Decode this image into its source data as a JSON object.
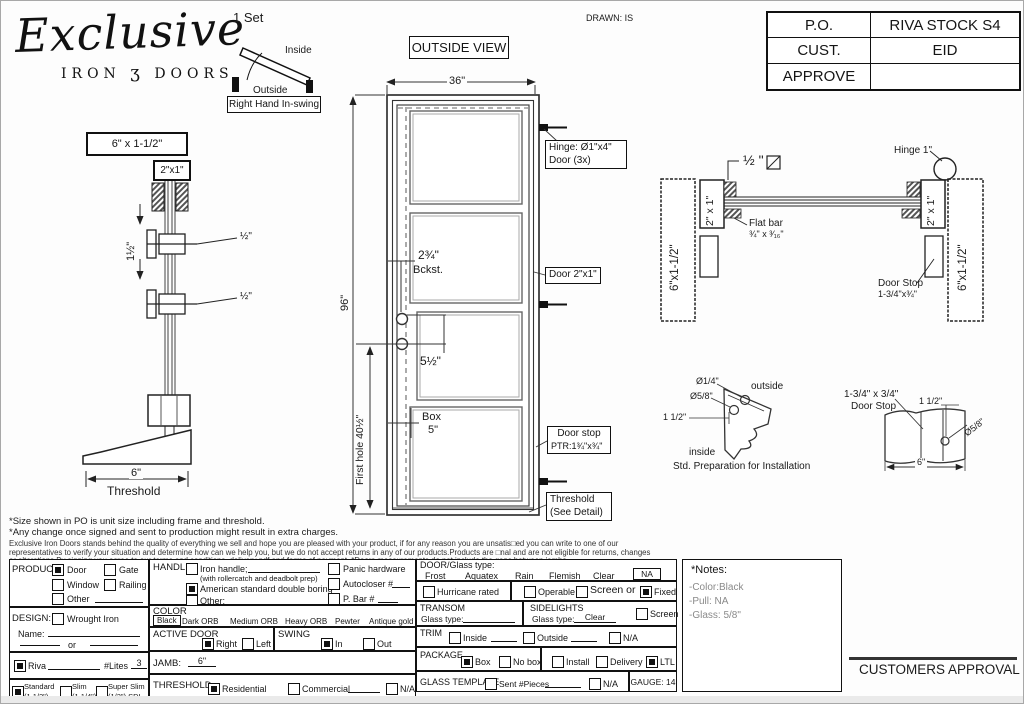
{
  "page": {
    "set_label": "1 Set",
    "drawn_by": "DRAWN: IS",
    "outside_view": "OUTSIDE VIEW",
    "approval_label": "CUSTOMERS APPROVAL"
  },
  "logo": {
    "title": "Exclusive",
    "sub_left": "IRON",
    "ornament": "ʒ",
    "sub_right": "DOORS"
  },
  "swing": {
    "inside": "Inside",
    "outside": "Outside",
    "caption": "Right Hand In-swing"
  },
  "po_table": {
    "rows": [
      {
        "label": "P.O.",
        "value": "RIVA STOCK S4"
      },
      {
        "label": "CUST.",
        "value": "EID"
      },
      {
        "label": "APPROVE",
        "value": ""
      }
    ]
  },
  "jamb_elevation": {
    "head": "6\" x 1-1/2\"",
    "frame": "2\"x1\"",
    "spacing": "1½\"",
    "callout_top": "½\"",
    "callout_bottom": "½\"",
    "base_dim": "6\"",
    "base_label": "Threshold"
  },
  "door_view": {
    "width_dim": "36\"",
    "height_dim": "96\"",
    "first_hole": "First hole 40½\"",
    "backset": "2¾\"",
    "backset_label": "Bckst.",
    "holes_dim": "5½\"",
    "box_label": "Box",
    "box_dim": "5\"",
    "hinge_note_1": "Hinge: Ø1\"x4\"",
    "hinge_note_2": "Door (3x)",
    "door_note": "Door 2\"x1\"",
    "stop_note_1": "Door stop",
    "stop_note_2": "PTR:1¾\"x¾\"",
    "threshold_note_1": "Threshold",
    "threshold_note_2": "(See Detail)"
  },
  "plan_view": {
    "left_jamb": "6\"x1-1/2\"",
    "left_frame": "2\" x 1\"",
    "gap_dim": "½ \"",
    "flat_bar_1": "Flat bar",
    "flat_bar_2": "¾\" x ³⁄₁₆\"",
    "hinge_label": "Hinge 1\"",
    "right_frame": "2\" x 1\"",
    "right_jamb": "6\"x1-1/2\"",
    "stop_1": "Door Stop",
    "stop_2": "1-3/4\"x¾\""
  },
  "corner_detail": {
    "dia_small": "Ø1/4\"",
    "dia_big": "Ø5/8\"",
    "outside": "outside",
    "dim": "1 1/2\"",
    "inside": "inside",
    "caption": "Std. Preparation for Installation"
  },
  "stop_detail": {
    "title_1": "1-3/4\" x 3/4\"",
    "title_2": "Door Stop",
    "dim": "1 1/2\"",
    "dia": "Ø5/8\"",
    "width_dim": "6\""
  },
  "disclaimer": {
    "line1": "*Size shown in PO is unit size including frame and threshold.",
    "line2": "*Any change once signed and sent to production might result in extra charges.",
    "line3": "Exclusive Iron Doors stands behind the quality of everything we sell and hope you are pleased with your product, if for any reason you are unsatis□ed you can write to one of our",
    "line4": "representatives to verify your situation and determine how can we help you, but we do not accept returns in any of our products.Products are □nal and are not eligible for returns, changes",
    "line5": "or alterations.By signing you agree to our terms and conditions, delivery pdf and forms of payment. *Doors measurements do not include the gaps between jambs"
  },
  "form": {
    "product": {
      "label": "PRODUCT:",
      "options": [
        {
          "l": "Door",
          "c": true
        },
        {
          "l": "Gate",
          "c": false
        },
        {
          "l": "Window",
          "c": false
        },
        {
          "l": "Railing",
          "c": false
        },
        {
          "l": "Other",
          "c": false
        }
      ]
    },
    "design": {
      "label": "DESIGN:",
      "wrought": {
        "l": "Wrought Iron",
        "c": false
      },
      "name_label": "Name:",
      "or_label": "or",
      "riva": {
        "l": "Riva",
        "c": true
      },
      "lites_label": "#Lites",
      "lites_value": "3",
      "profiles": [
        {
          "l": "Standard",
          "s": "(1 1/2\")",
          "c": true
        },
        {
          "l": "Slim",
          "s": "(1 1/4\")",
          "c": false
        },
        {
          "l": "Super Slim",
          "s": "(1/2\") SDL",
          "c": false
        }
      ]
    },
    "handle": {
      "label": "HANDLE",
      "options": [
        {
          "l": "Iron handle;",
          "c": false
        },
        {
          "l": "American standard double boring",
          "c": true
        },
        {
          "l": "Other:",
          "c": false
        }
      ],
      "note": "(with rollercatch and deadbolt prep)",
      "extras": [
        {
          "l": "Panic hardware",
          "c": false
        },
        {
          "l": "Autocloser #",
          "c": false
        },
        {
          "l": "P. Bar #",
          "c": false
        }
      ]
    },
    "color": {
      "label": "COLOR",
      "selected": "Black",
      "options": [
        "Black",
        "Dark ORB",
        "Medium ORB",
        "Heavy ORB",
        "Pewter",
        "Antique gold"
      ]
    },
    "active_door": {
      "label": "ACTIVE DOOR",
      "options": [
        {
          "l": "Right",
          "c": true
        },
        {
          "l": "Left",
          "c": false
        }
      ]
    },
    "swing": {
      "label": "SWING",
      "options": [
        {
          "l": "In",
          "c": true
        },
        {
          "l": "Out",
          "c": false
        }
      ]
    },
    "jamb": {
      "label": "JAMB:",
      "value": "6\""
    },
    "threshold": {
      "label": "THRESHOLD",
      "options": [
        {
          "l": "Residential",
          "c": true
        },
        {
          "l": "Commercial",
          "c": false
        },
        {
          "l": "N/A",
          "c": false
        }
      ]
    },
    "door_glass": {
      "label": "DOOR/Glass type:",
      "types": [
        "Frost",
        "Aquatex",
        "Rain",
        "Flemish",
        "Clear"
      ],
      "na": "NA",
      "hurricane": {
        "l": "Hurricane rated",
        "c": false
      },
      "operable": {
        "l": "Operable",
        "c": false
      },
      "screen": {
        "l": "",
        "c": false
      },
      "screen_or": "Screen or",
      "fixed": {
        "l": "Fixed",
        "c": true
      }
    },
    "transom": {
      "label": "TRANSOM",
      "glass_label": "Glass type:"
    },
    "sidelights": {
      "label": "SIDELIGHTS",
      "glass_label": "Glass type:",
      "glass_value": "Clear",
      "screen": {
        "l": "Screen",
        "c": false
      }
    },
    "trim": {
      "label": "TRIM",
      "options": [
        {
          "l": "Inside",
          "c": false
        },
        {
          "l": "Outside",
          "c": false
        },
        {
          "l": "N/A",
          "c": false
        }
      ]
    },
    "package": {
      "label": "PACKAGE",
      "options": [
        {
          "l": "Box",
          "c": true
        },
        {
          "l": "No box",
          "c": false
        },
        {
          "l": "Install",
          "c": false
        },
        {
          "l": "Delivery",
          "c": false
        },
        {
          "l": "LTL",
          "c": true
        }
      ]
    },
    "glass_template": {
      "label": "GLASS TEMPLATE",
      "sent": {
        "l": "Sent #Pieces",
        "c": false
      },
      "na": {
        "l": "N/A",
        "c": false
      },
      "gauge": "GAUGE: 14"
    }
  },
  "notes": {
    "title": "*Notes:",
    "line1": "-Color:Black",
    "line2": "-Pull: NA",
    "line3": "-Glass: 5/8\""
  }
}
